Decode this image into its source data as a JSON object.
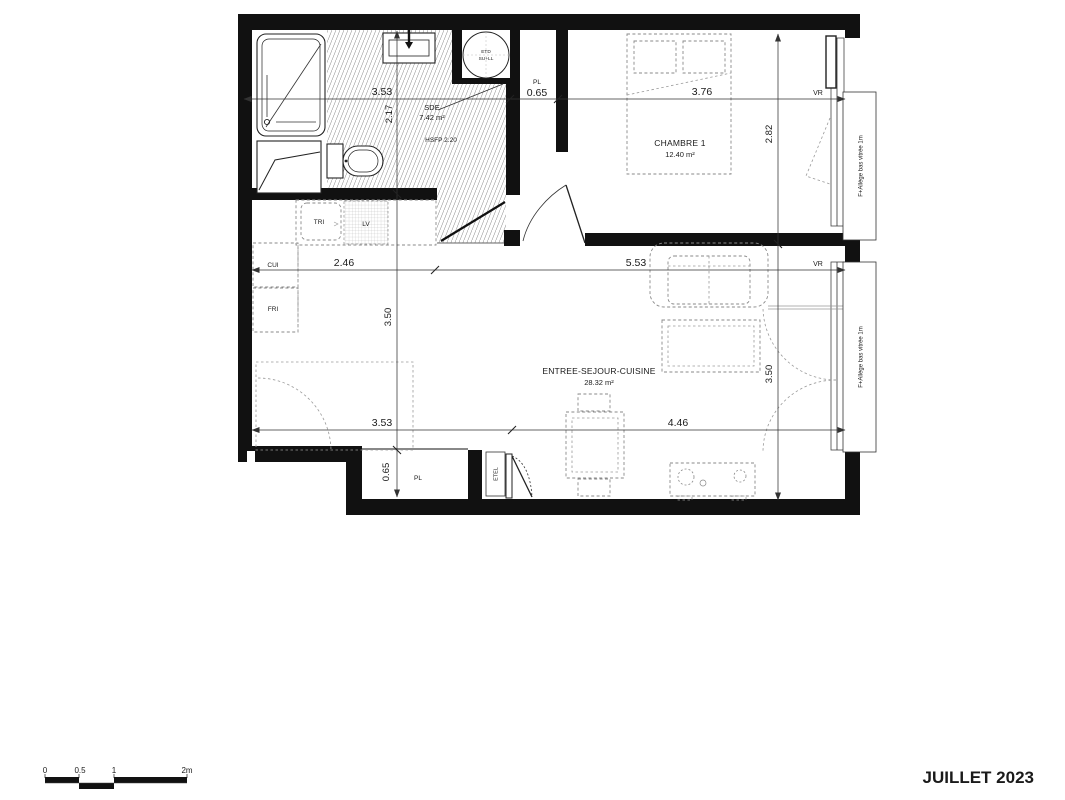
{
  "title_block": {
    "date": "JUILLET 2023"
  },
  "scale_bar": {
    "labels": [
      "0",
      "0.5",
      "1",
      "2m"
    ]
  },
  "rooms": {
    "sde": {
      "name": "SDE",
      "area": "7.42 m²",
      "ceiling_note": "HSFP 2.20"
    },
    "chambre": {
      "name": "CHAMBRE 1",
      "area": "12.40 m²"
    },
    "sejour": {
      "name": "ENTREE-SEJOUR-CUISINE",
      "area": "28.32 m²"
    }
  },
  "labels": {
    "pl_top": "PL",
    "pl_bottom": "PL",
    "etel": "ETEL",
    "tri": "TRI",
    "lv": "LV",
    "cui": "CUI",
    "fri": "FRI",
    "laundry_line1": "ETD",
    "laundry_line2": "SU+LL",
    "vr_top": "VR",
    "vr_mid": "VR",
    "window_note_top": "F+Allège bas vitrée 1m",
    "window_note_bottom": "F+Allège bas vitrée 1m"
  },
  "dimensions": {
    "sde_width": "3.53",
    "pl_width": "0.65",
    "chambre_width": "3.76",
    "sde_depth": "2.17",
    "chambre_depth": "2.82",
    "kitchen_width": "2.46",
    "sejour_width": "5.53",
    "kitchen_depth": "3.50",
    "window_height": "3.50",
    "sejour_left_width": "3.53",
    "sejour_right_width": "4.46",
    "pl_bottom_depth": "0.65"
  }
}
